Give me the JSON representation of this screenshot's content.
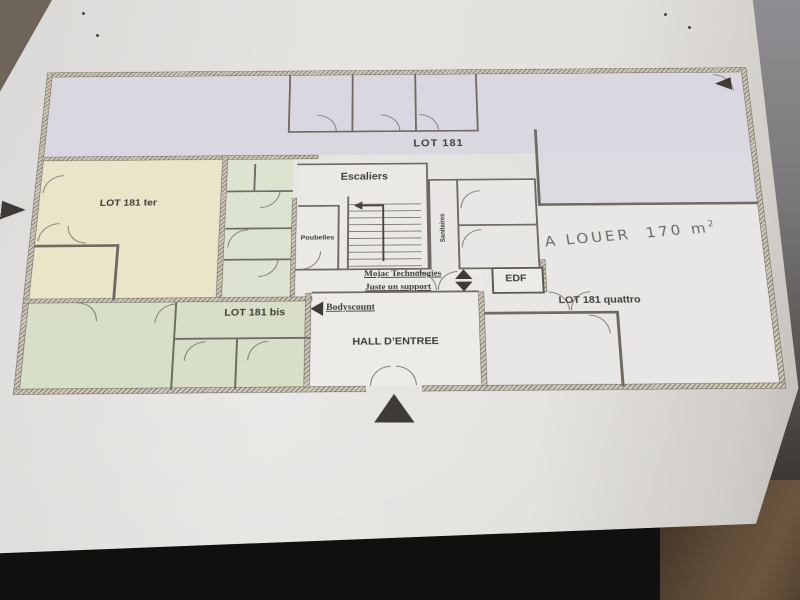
{
  "photo": {
    "paper_color": "#e4e2df",
    "backdrop_color": "#12100e",
    "wood_color": "#5e4b37",
    "arrow_color": "#3e3a35"
  },
  "plan": {
    "zones": {
      "lot181": {
        "label": "LOT 181",
        "fill": "#d9d8e0"
      },
      "ter": {
        "label": "LOT 181 ter",
        "fill": "#eae5c9"
      },
      "bis": {
        "label": "LOT 181 bis",
        "fill": "#d7dfc9"
      },
      "quattro": {
        "label": "LOT 181 quattro",
        "fill": "#e9e7e5"
      },
      "hall": {
        "label": "HALL D’ENTREE"
      },
      "escaliers": {
        "label": "Escaliers"
      },
      "poubelles": {
        "label": "Poubelles"
      },
      "sanitaires": {
        "label": "Sanitaires"
      },
      "edf": {
        "label": "EDF"
      }
    },
    "notes": {
      "mojac": "Mojac Technologies",
      "juste": "Juste un support",
      "bodyscount": "Bodyscount",
      "a_louer": "A LOUER",
      "area": "170 m",
      "area_exp": "2"
    },
    "icons": [
      "entrance-arrow-icon",
      "left-edge-arrow-icon",
      "top-right-arrow-icon",
      "corridor-up-arrow-icon",
      "corridor-down-arrow-icon",
      "bodyscount-arrow-icon"
    ]
  }
}
